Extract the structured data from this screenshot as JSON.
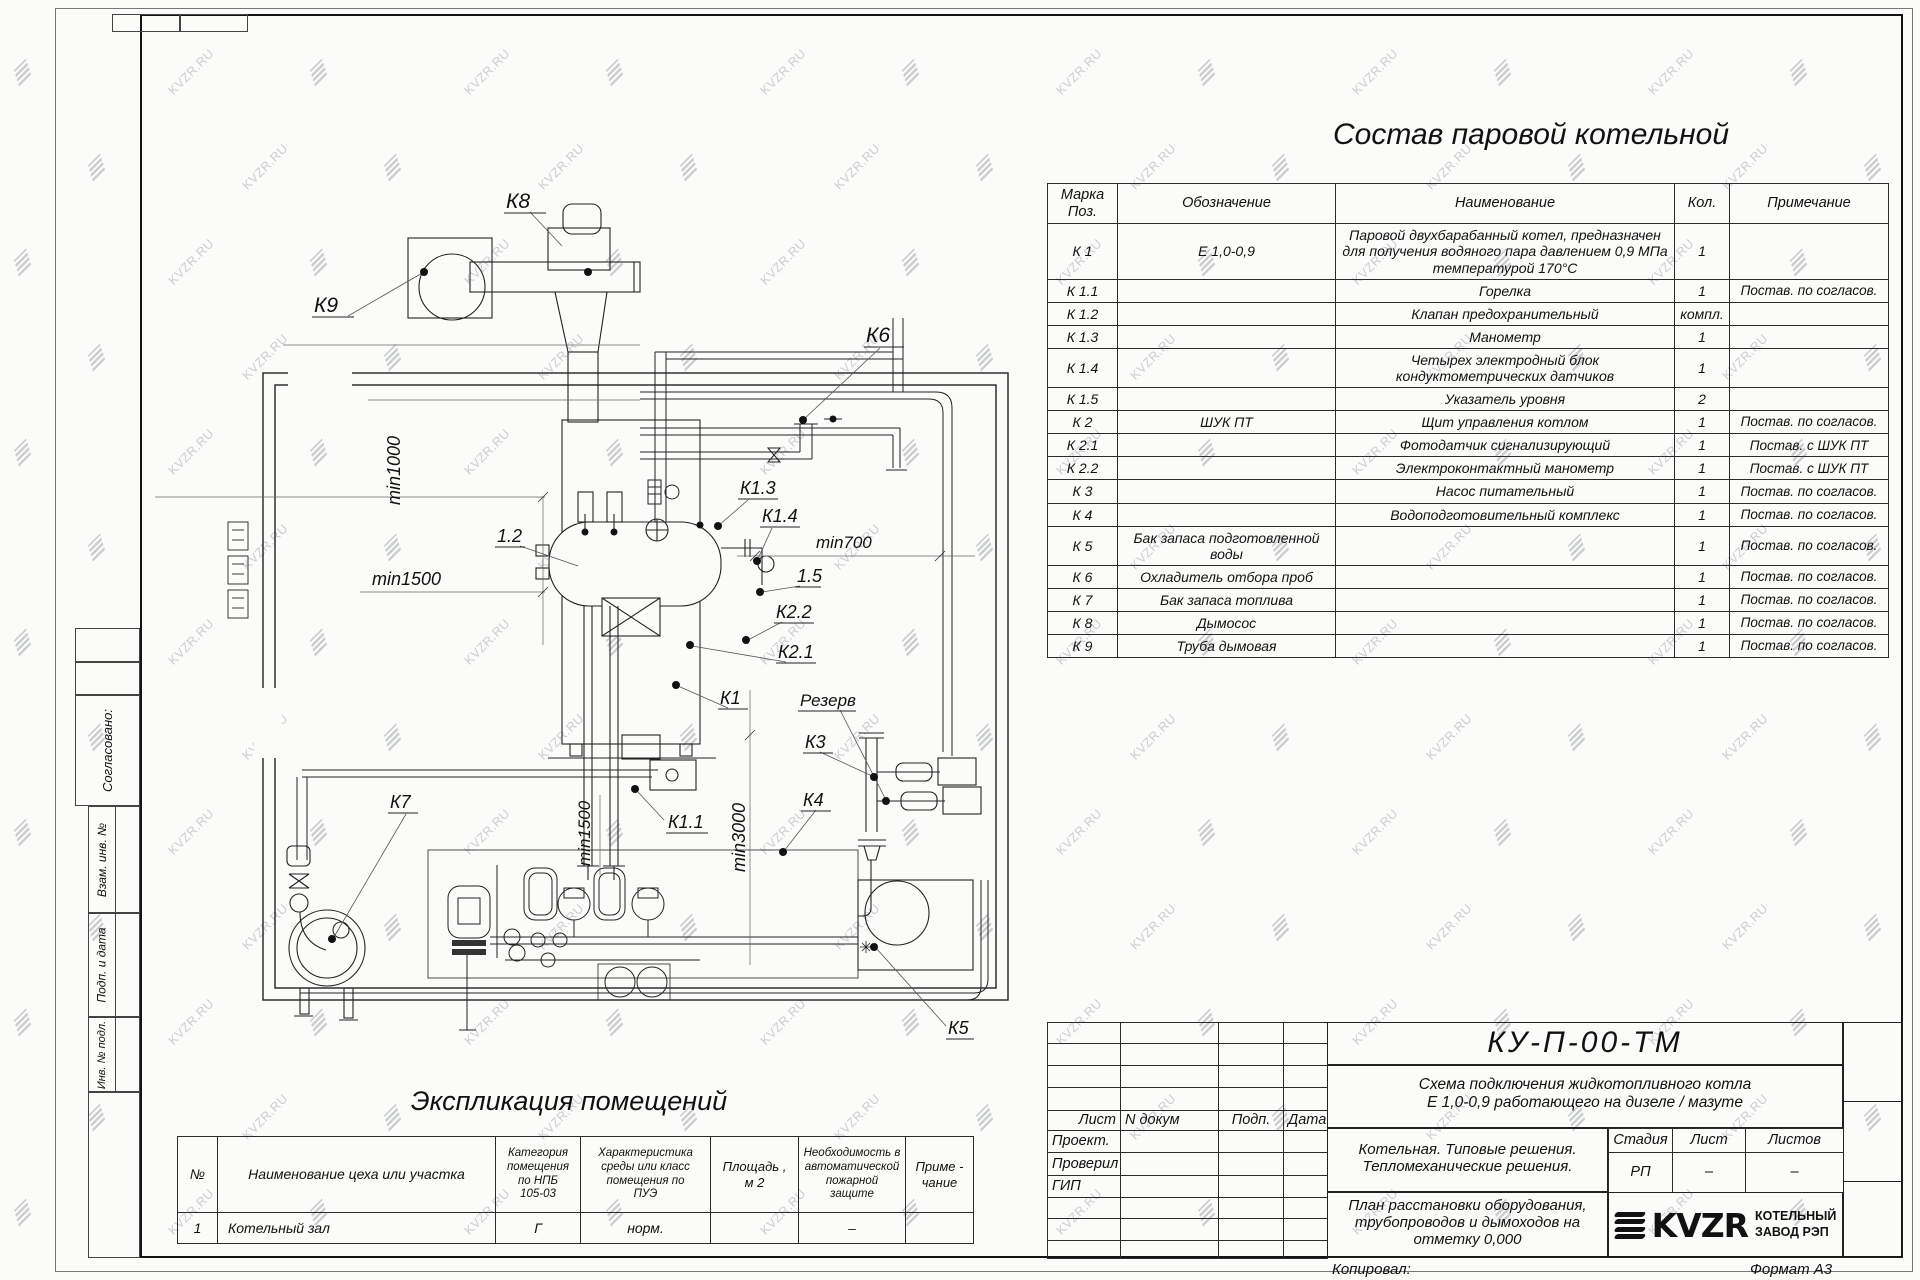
{
  "watermark": {
    "text": "KVZR.RU"
  },
  "frame": {
    "approved_label": "Согласовано:",
    "stamp_col1": "Взам. инв. №",
    "stamp_col2": "Подп. и дата",
    "stamp_col3": "Инв. № подл."
  },
  "sostav": {
    "title": "Состав паровой котельной",
    "headers": [
      "Марка\nПоз.",
      "Обозначение",
      "Наименование",
      "Кол.",
      "Примечание"
    ],
    "rows": [
      [
        "К 1",
        "Е  1,0-0,9",
        "Паровой двухбарабанный котел, предназначен для получения водяного пара давлением 0,9 МПа температурой 170°С",
        "1",
        ""
      ],
      [
        "К 1.1",
        "",
        "Горелка",
        "1",
        "Постав. по согласов."
      ],
      [
        "К 1.2",
        "",
        "Клапан предохранительный",
        "компл.",
        ""
      ],
      [
        "К 1.3",
        "",
        "Манометр",
        "1",
        ""
      ],
      [
        "К 1.4",
        "",
        "Четырех электродный блок кондуктометрических датчиков",
        "1",
        ""
      ],
      [
        "К 1.5",
        "",
        "Указатель уровня",
        "2",
        ""
      ],
      [
        "К 2",
        "ШУК ПТ",
        "Щит управления котлом",
        "1",
        "Постав. по согласов."
      ],
      [
        "К 2.1",
        "",
        "Фотодатчик сигнализирующий",
        "1",
        "Постав. с ШУК ПТ"
      ],
      [
        "К 2.2",
        "",
        "Электроконтактный манометр",
        "1",
        "Постав. с ШУК ПТ"
      ],
      [
        "К 3",
        "",
        "Насос питательный",
        "1",
        "Постав. по согласов."
      ],
      [
        "К 4",
        "",
        "Водоподготовительный комплекс",
        "1",
        "Постав. по согласов."
      ],
      [
        "К 5",
        "Бак запаса подготовленной воды",
        "",
        "1",
        "Постав. по согласов."
      ],
      [
        "К 6",
        "Охладитель отбора проб",
        "",
        "1",
        "Постав. по согласов."
      ],
      [
        "К 7",
        "Бак запаса топлива",
        "",
        "1",
        "Постав. по согласов."
      ],
      [
        "К 8",
        "Дымосос",
        "",
        "1",
        "Постав. по согласов."
      ],
      [
        "К 9",
        "Труба дымовая",
        "",
        "1",
        "Постав. по согласов."
      ]
    ]
  },
  "eksplikatsiya": {
    "title": "Экспликация помещений",
    "headers": [
      "№",
      "Наименование цеха или участка",
      "Категория\nпомещения\nпо НПБ\n105-03",
      "Характеристика\nсреды или класс\nпомещения по\nПУЭ",
      "Площадь ,\nм 2",
      "Необходимость в\nавтоматической\nпожарной защите",
      "Приме -\nчание"
    ],
    "rows": [
      [
        "1",
        "Котельный зал",
        "Г",
        "норм.",
        "",
        "–",
        ""
      ]
    ]
  },
  "titleblock": {
    "doc_code": "КУ-П-00-ТМ",
    "scheme_line1": "Схема подключения жидкотопливного котла",
    "scheme_line2": "Е 1,0-0,9 работающего на дизеле / мазуте",
    "left_header": [
      "Лист",
      "N докум",
      "Подп.",
      "Дата"
    ],
    "left_rows": [
      "Проект.",
      "Проверил",
      "ГИП"
    ],
    "section_line1": "Котельная. Типовые решения.",
    "section_line2": "Тепломеханические решения.",
    "stage_headers": [
      "Стадия",
      "Лист",
      "Листов"
    ],
    "stage_values": [
      "РП",
      "–",
      "–"
    ],
    "sheet_line1": "План расстановки оборудования,",
    "sheet_line2": "трубопроводов и дымоходов на",
    "sheet_line3": "отметку  0,000",
    "logo_text": "KVZR",
    "logo_sub1": "КОТЕЛЬНЫЙ",
    "logo_sub2": "ЗАВОД РЭП",
    "copied_label": "Копировал:",
    "format_label": "Формат А3"
  },
  "plan": {
    "labels": [
      {
        "t": "К8",
        "x": 506,
        "y": 208,
        "r": 0,
        "s": 21,
        "u": 42
      },
      {
        "t": "К9",
        "x": 314,
        "y": 312,
        "r": 0,
        "s": 21,
        "u": 42
      },
      {
        "t": "К6",
        "x": 866,
        "y": 342,
        "r": 0,
        "s": 21,
        "u": 40
      },
      {
        "t": "min1000",
        "x": 400,
        "y": 505,
        "r": -90,
        "s": 18,
        "u": 0
      },
      {
        "t": "1.2",
        "x": 497,
        "y": 542,
        "r": 0,
        "s": 18,
        "u": 30
      },
      {
        "t": "min1500",
        "x": 372,
        "y": 585,
        "r": 0,
        "s": 18,
        "u": 0
      },
      {
        "t": "К1.3",
        "x": 740,
        "y": 494,
        "r": 0,
        "s": 18,
        "u": 40
      },
      {
        "t": "К1.4",
        "x": 762,
        "y": 522,
        "r": 0,
        "s": 18,
        "u": 40
      },
      {
        "t": "min700",
        "x": 816,
        "y": 548,
        "r": 0,
        "s": 17,
        "u": 0
      },
      {
        "t": "1.5",
        "x": 797,
        "y": 582,
        "r": 0,
        "s": 18,
        "u": 26
      },
      {
        "t": "К2.2",
        "x": 776,
        "y": 618,
        "r": 0,
        "s": 18,
        "u": 40
      },
      {
        "t": "К2.1",
        "x": 778,
        "y": 658,
        "r": 0,
        "s": 18,
        "u": 40
      },
      {
        "t": "К1",
        "x": 720,
        "y": 704,
        "r": 0,
        "s": 18,
        "u": 30
      },
      {
        "t": "Резерв",
        "x": 800,
        "y": 706,
        "r": 0,
        "s": 17,
        "u": 58
      },
      {
        "t": "К3",
        "x": 805,
        "y": 748,
        "r": 0,
        "s": 18,
        "u": 30
      },
      {
        "t": "К4",
        "x": 803,
        "y": 806,
        "r": 0,
        "s": 18,
        "u": 30
      },
      {
        "t": "К1.1",
        "x": 668,
        "y": 828,
        "r": 0,
        "s": 18,
        "u": 42
      },
      {
        "t": "min3000",
        "x": 745,
        "y": 872,
        "r": -90,
        "s": 18,
        "u": 0
      },
      {
        "t": "К7",
        "x": 390,
        "y": 808,
        "r": 0,
        "s": 18,
        "u": 30
      },
      {
        "t": "min1500",
        "x": 590,
        "y": 866,
        "r": -90,
        "s": 17,
        "u": 0
      },
      {
        "t": "К5",
        "x": 948,
        "y": 1034,
        "r": 0,
        "s": 18,
        "u": 28
      }
    ]
  }
}
